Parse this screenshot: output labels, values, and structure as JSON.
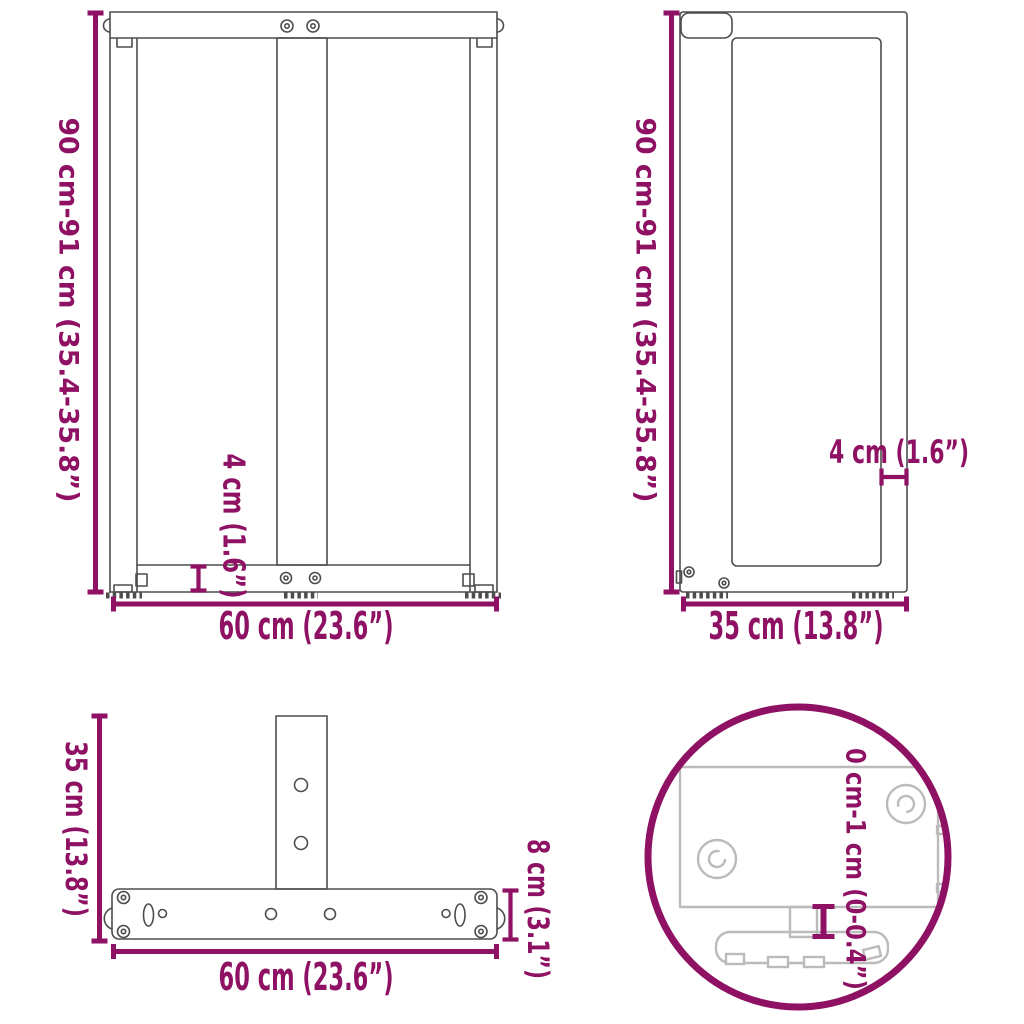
{
  "diagram": {
    "accent_color": "#8E1164",
    "drawing_line_color": "#4D4D4D",
    "detail_line_color": "#BBBBBB",
    "background_color": "#FFFFFF"
  },
  "views": {
    "front": {
      "height_label": "90 cm-91 cm (35.4-35.8”)",
      "foot_bar_height_label": "4 cm (1.6”)",
      "width_label": "60 cm (23.6”)"
    },
    "side": {
      "height_label": "90 cm-91 cm (35.4-35.8”)",
      "post_thickness_label": "4 cm (1.6”)",
      "depth_label": "35 cm (13.8”)"
    },
    "top": {
      "depth_label": "35 cm (13.8”)",
      "width_label": "60 cm (23.6”)",
      "crossbar_depth_label": "8 cm (3.1”)"
    },
    "detail": {
      "adjustment_range_label": "0 cm-1 cm (0-0.4”)"
    }
  }
}
